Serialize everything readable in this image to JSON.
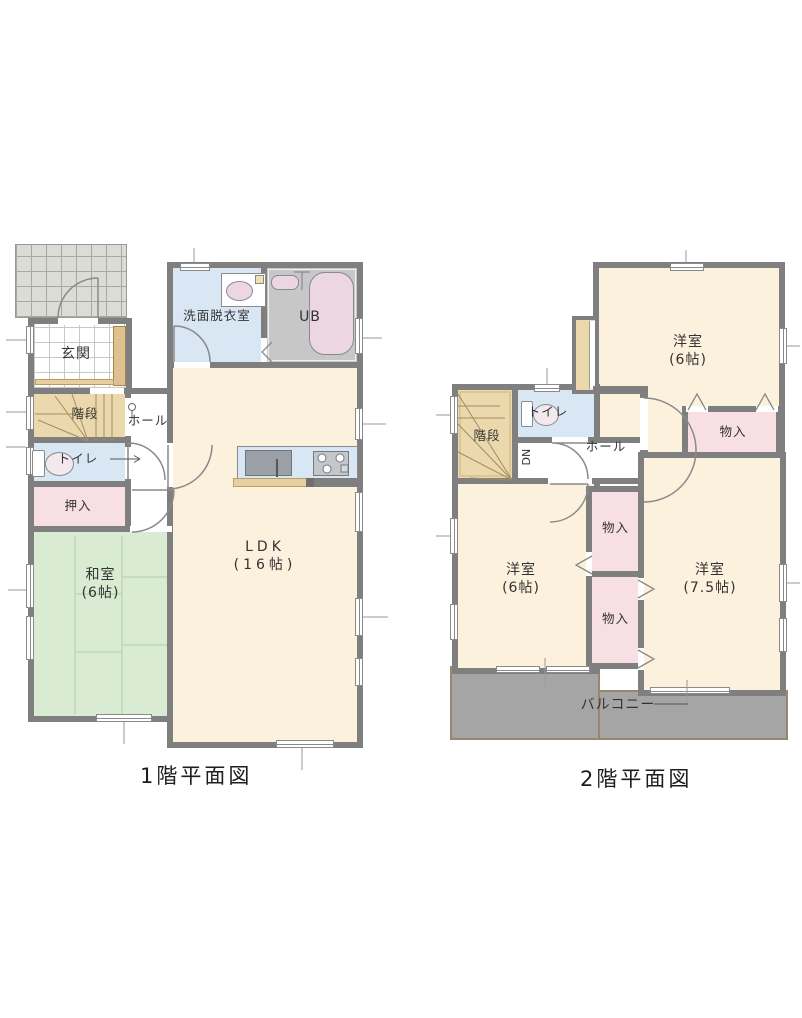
{
  "floor1": {
    "title": "1階平面図",
    "rooms": {
      "genkan": "玄関",
      "kaidan": "階段",
      "toire": "トイレ",
      "oshiire": "押入",
      "washitsu": "和室\n(6帖)",
      "ldk": "LDK\n(16帖)",
      "senmen": "洗面脱衣室",
      "ub": "UB",
      "hall": "ホール"
    }
  },
  "floor2": {
    "title": "2階平面図",
    "rooms": {
      "kaidan": "階段",
      "toire": "トイレ",
      "dn": "DN",
      "hall": "ホール",
      "yoshitsu_a": "洋室\n(6帖)",
      "yoshitsu_b": "洋室\n(6帖)",
      "yoshitsu_c": "洋室\n(7.5帖)",
      "monoire": "物入",
      "balcony": "バルコニー"
    }
  },
  "colors": {
    "wall": "#7f7f7f",
    "room_cream": "#fbf1dd",
    "water_blue": "#d8e7f3",
    "closet_pink": "#f7dfe4",
    "stair_tan": "#ebd8ad",
    "tatami_green": "#d9ebd3",
    "balcony_gray": "#a5a5a5",
    "ub_gray": "#c7c7c7",
    "fixture_pink": "#ecd6e2"
  }
}
